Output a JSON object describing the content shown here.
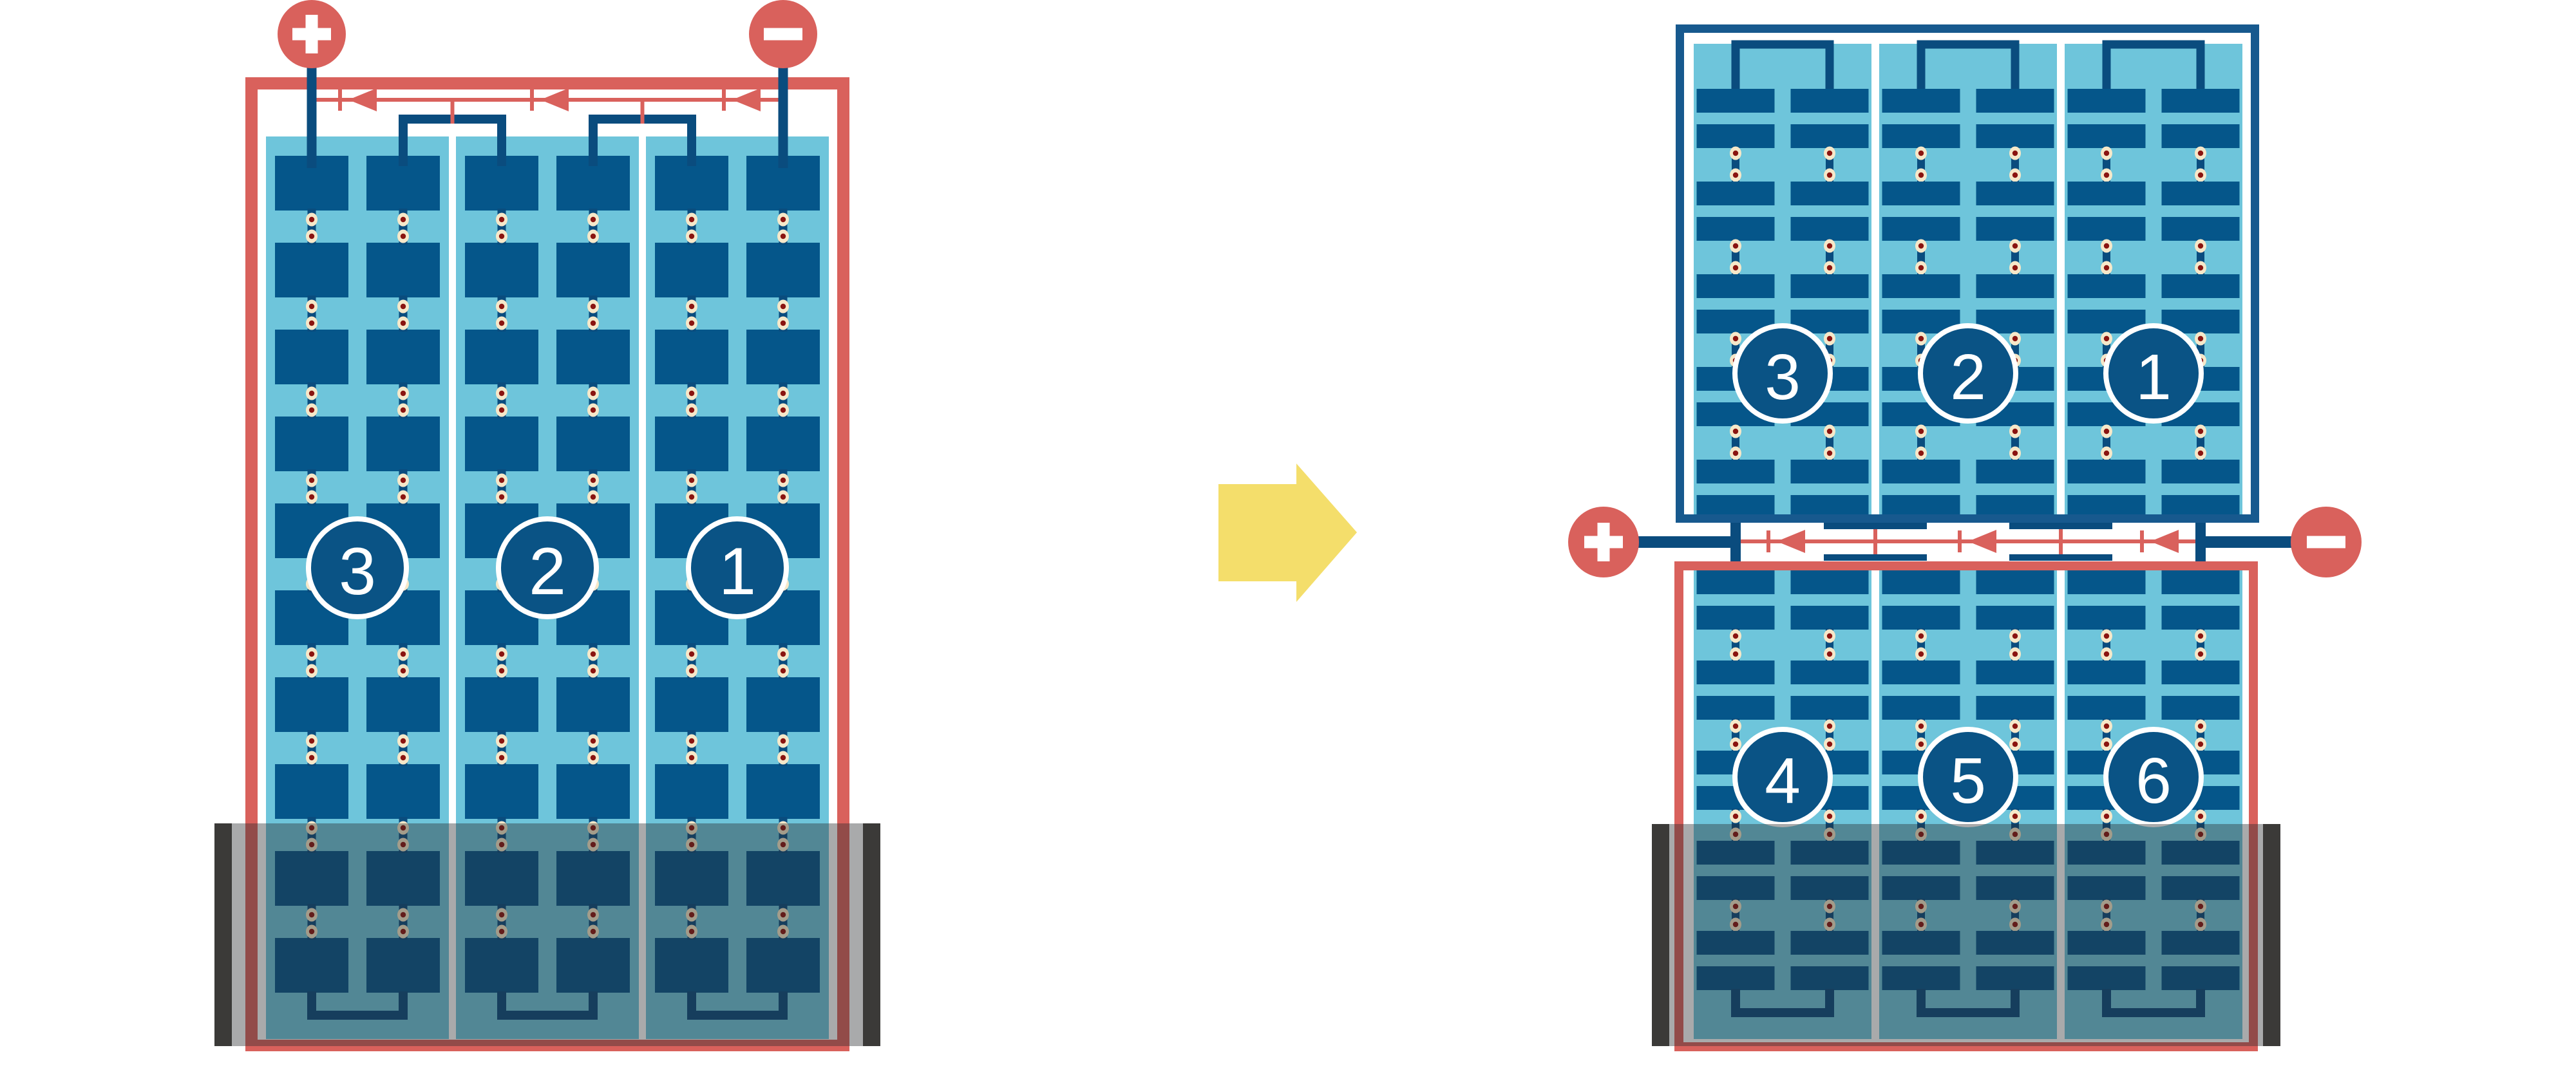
{
  "colors": {
    "red": "#D9615C",
    "cell_navy": "#05568A",
    "connector_navy": "#0A4C7E",
    "frame_blue": "#17598E",
    "circle_fill": "#0A5385",
    "light_blue": "#6EC5DB",
    "cream": "#F6E8C9",
    "dot_red": "#8A1410",
    "arrow_yellow": "#F4DE6B",
    "charcoal": "#3B3A38",
    "shade": "rgba(40,42,45,0.4)",
    "white": "#FFFFFF"
  },
  "left_module": {
    "kind": "full-cell-module",
    "strings": [
      {
        "label": "3"
      },
      {
        "label": "2"
      },
      {
        "label": "1"
      }
    ],
    "terminals": {
      "positive": "+",
      "negative": "−"
    },
    "bypass_diodes": 3,
    "cell_rows": 10,
    "substrings_per_string": 2,
    "shaded_bottom": true
  },
  "right_top_module": {
    "kind": "half-cell-upper-module",
    "strings": [
      {
        "label": "3"
      },
      {
        "label": "2"
      },
      {
        "label": "1"
      }
    ],
    "cell_row_pairs": 5,
    "substrings_per_string": 2
  },
  "right_bottom_module": {
    "kind": "half-cell-lower-module",
    "strings": [
      {
        "label": "4"
      },
      {
        "label": "5"
      },
      {
        "label": "6"
      }
    ],
    "cell_row_pairs": 5,
    "substrings_per_string": 2,
    "shaded_bottom": true
  },
  "right_system": {
    "terminals": {
      "positive": "+",
      "negative": "−"
    },
    "bypass_diodes": 3
  },
  "transition_arrow": {
    "direction": "right"
  }
}
